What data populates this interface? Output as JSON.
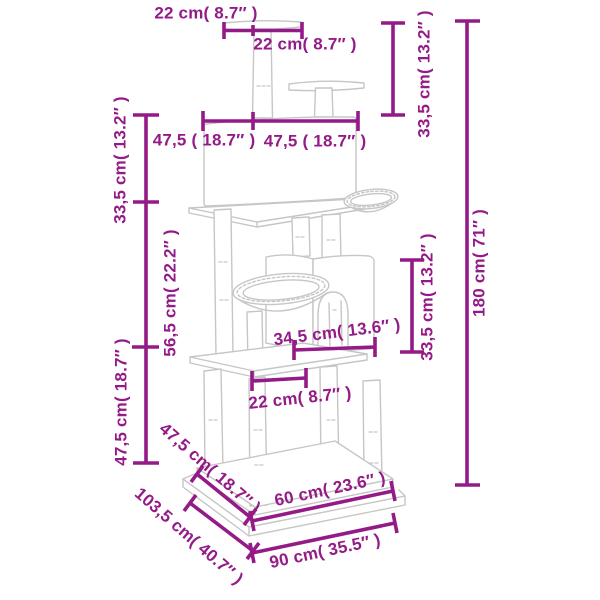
{
  "theme": {
    "dimension_color": "#941B87",
    "drawing_line_color": "#C6C6C6",
    "background": "#FFFFFF"
  },
  "diagram": {
    "subject": "cat-tree-dimension-diagram"
  },
  "dims": {
    "top_platform_left": "22 cm( 8.7″ )",
    "top_platform_right": "22 cm( 8.7″ )",
    "top_section_height": "33,5 cm( 13.2″ )",
    "total_height": "180 cm( 71″ )",
    "condo_section_height": "33,5 cm( 13.2″ )",
    "middle_section_height": "56,5 cm( 22.2″ )",
    "lower_section_height": "47,5 cm( 18.7″ )",
    "condo_width_left": "47,5 ( 18.7″ )",
    "condo_width_right": "47,5 ( 18.7″ )",
    "house_height": "33,5 cm( 13.2″ )",
    "mid_platform_depth": "34,5 cm( 13.6″ )",
    "mid_platform_front": "22 cm( 8.7″ )",
    "upper_base_depth": "47,5 cm( 18.7″ )",
    "lower_base_depth": "103,5 cm( 40.7″ )",
    "upper_base_width": "60 cm( 23.6″ )",
    "lower_base_width": "90 cm( 35.5″ )"
  }
}
